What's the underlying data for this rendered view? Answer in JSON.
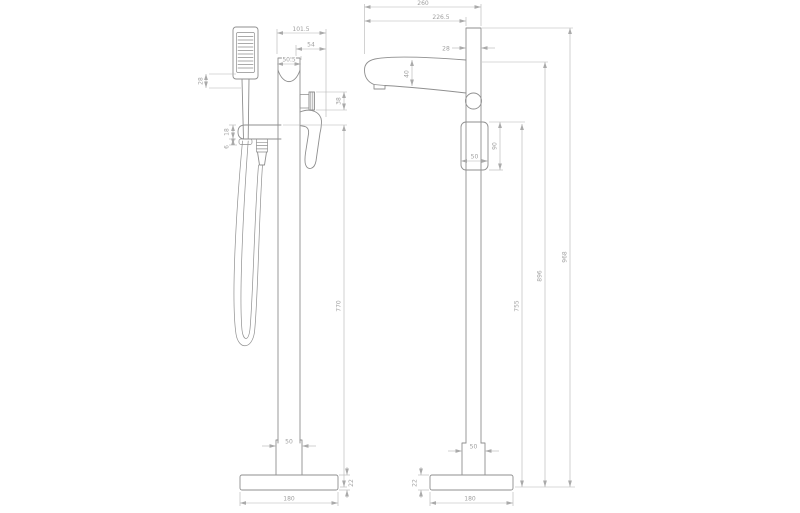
{
  "drawing": {
    "type": "technical-dimension-drawing",
    "subject": "Freestanding floor-standing bath shower mixer tap with handset — side and front elevations",
    "units": "mm",
    "colors": {
      "background": "#ffffff",
      "product_outline": "#8f8f8f",
      "dimension_lines": "#b4b4b4",
      "dimension_text": "#a0a0a0"
    },
    "side_view": {
      "label": "side elevation with shower handset",
      "dims": {
        "overall_depth": "101.5",
        "lever_projection": "54",
        "body_depth": "50.5",
        "handset_offset": "28",
        "bracket_height": "18",
        "bracket_lip": "6",
        "knob_height": "38",
        "holder_height_from_floor": "770",
        "column_width": "50",
        "base_diameter": "180",
        "base_height": "22"
      }
    },
    "front_view": {
      "label": "front elevation",
      "dims": {
        "overall_projection": "260",
        "spout_projection": "226.5",
        "column_width": "28",
        "spout_depth": "40",
        "lever_width": "50",
        "lever_height": "90",
        "column_bottom_width": "50",
        "base_height": "22",
        "base_diameter": "180",
        "cartridge_height_from_floor": "755",
        "spout_height_from_floor": "896",
        "overall_height": "968"
      }
    }
  }
}
